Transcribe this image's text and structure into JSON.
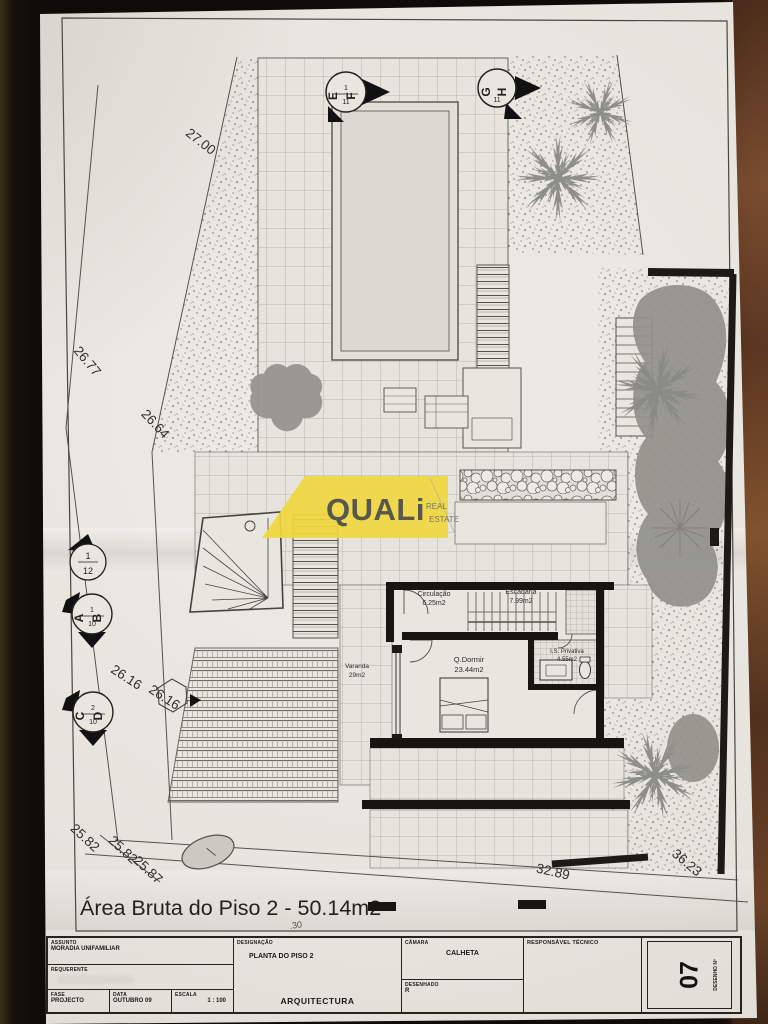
{
  "plan": {
    "area_note": "Área Bruta do Piso 2 - 50.14m2",
    "small_note": ".30",
    "rooms": {
      "circulacao": {
        "name": "Circulação",
        "area": "6.25m2"
      },
      "escadaria": {
        "name": "Escadaria",
        "area": "7.99m2"
      },
      "qdormir": {
        "name": "Q.Dormir",
        "area": "23.44m2"
      },
      "is_privativa": {
        "name": "I.S. Privativa",
        "area": "4.55m2"
      },
      "varanda": {
        "name": "Varanda",
        "area": "29m2"
      }
    },
    "dimensions": {
      "top": "27.00",
      "left_upper": "26.77",
      "left_mid": "26.64",
      "left_lower_a": "26.16",
      "left_lower_b": "26.16",
      "bottom_a": "25.82",
      "bottom_b": "25.82",
      "bottom_c": "25.87",
      "bottom_right": "32.89",
      "right_corner": "36.23"
    },
    "markers": {
      "ef": {
        "left": "E",
        "right": "F",
        "num_top": "1",
        "num_bottom": "11"
      },
      "gh": {
        "left": "G",
        "right": "H",
        "num_bottom": "11"
      },
      "m12": {
        "num_top": "1",
        "num_bottom": "12"
      },
      "ab": {
        "left": "A",
        "right": "B",
        "num_top": "1",
        "num_bottom": "10"
      },
      "cd": {
        "left": "C",
        "right": "D",
        "num_top": "2",
        "num_bottom": "10"
      }
    }
  },
  "logo": {
    "brand": "QUALi",
    "sub_top": "REAL",
    "sub_bottom": "ESTATE",
    "bg": "#f0d73e"
  },
  "titleblock": {
    "assunto_label": "ASSUNTO",
    "assunto_value": "MORADIA UNIFAMILIAR",
    "requerente_label": "REQUERENTE",
    "fase_label": "FASE",
    "fase_value": "PROJECTO",
    "data_label": "DATA",
    "data_value": "OUTUBRO 09",
    "escala_label": "ESCALA",
    "escala_value": "1 : 100",
    "designacao_label": "DESIGNAÇÃO",
    "designacao_value": "PLANTA DO PISO 2",
    "arquitectura": "ARQUITECTURA",
    "camara_label": "CÂMARA",
    "camara_value": "CALHETA",
    "desenhado_label": "DESENHADO",
    "desenhado_value": "R",
    "responsavel_label": "RESPONSÁVEL TÉCNICO",
    "desenho_num_label": "DESENHO Nº",
    "desenho_num_value": "07"
  },
  "colors": {
    "paper": "#e9e6e0",
    "ink": "#2b2b2b",
    "tree_gray": "#8d8d88",
    "logo_yellow": "#f0d73e"
  }
}
